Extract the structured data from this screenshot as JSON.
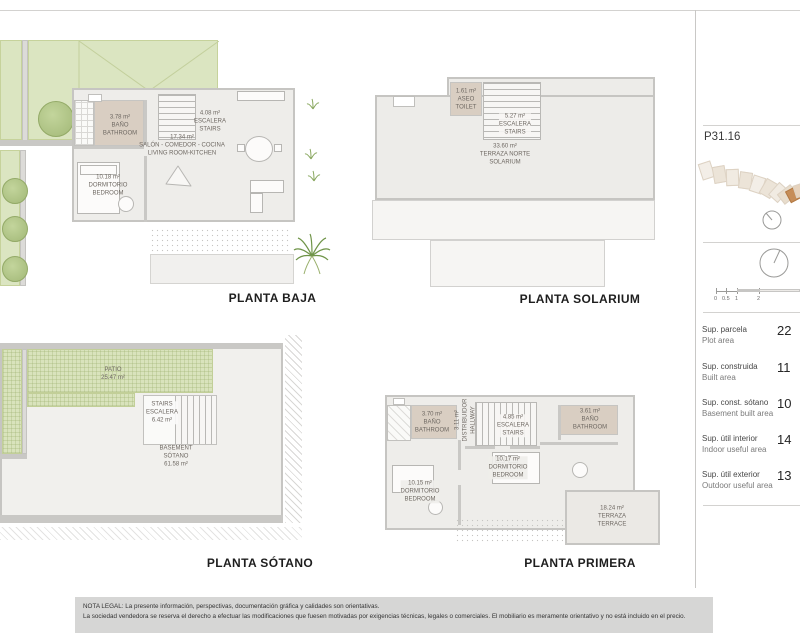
{
  "sheet": {
    "plot_id": "P31.16",
    "legal": {
      "line1": "NOTA LEGAL: La presente información, perspectivas, documentación gráfica y calidades son orientativas.",
      "line2": "La sociedad vendedora se reserva el derecho a efectuar las modificaciones que fuesen motivadas por exigencias técnicas, legales o comerciales. El mobiliario es meramente orientativo y no está incluido en el precio."
    }
  },
  "plans": {
    "baja": {
      "title": "PLANTA BAJA",
      "rooms": {
        "bano": {
          "area": "3.78 m²",
          "es": "BAÑO",
          "en": "BATHROOM"
        },
        "escalera": {
          "area": "4.08 m²",
          "es": "ESCALERA",
          "en": "STAIRS"
        },
        "salon": {
          "area": "17.34 m²",
          "es": "SALÓN - COMEDOR - COCINA",
          "en": "LIVING ROOM-KITCHEN"
        },
        "dormitorio": {
          "area": "10.18 m²",
          "es": "DORMITORIO",
          "en": "BEDROOM"
        }
      }
    },
    "solarium": {
      "title": "PLANTA SOLARIUM",
      "rooms": {
        "aseo": {
          "area": "1.61 m²",
          "es": "ASEO",
          "en": "TOILET"
        },
        "escalera": {
          "area": "5.27 m²",
          "es": "ESCALERA",
          "en": "STAIRS"
        },
        "terraza": {
          "area": "33.60 m²",
          "es": "TERRAZA NORTE",
          "en": "SOLARIUM"
        }
      }
    },
    "sotano": {
      "title": "PLANTA SÓTANO",
      "rooms": {
        "patio": {
          "es": "PATIO",
          "area": "25.47 m²"
        },
        "escalera": {
          "en": "STAIRS",
          "es": "ESCALERA",
          "area": "6.42 m²"
        },
        "sotano": {
          "en": "BASEMENT",
          "es": "SÓTANO",
          "area": "61.58 m²"
        }
      }
    },
    "primera": {
      "title": "PLANTA PRIMERA",
      "rooms": {
        "bano1": {
          "area": "3.70 m²",
          "es": "BAÑO",
          "en": "BATHROOM"
        },
        "distribuidor": {
          "area": "3.11 m²",
          "es": "DISTRIBUIDOR",
          "en": "HALLWAY"
        },
        "escalera": {
          "area": "4.85 m²",
          "es": "ESCALERA",
          "en": "STAIRS"
        },
        "bano2": {
          "area": "3.61 m²",
          "es": "BAÑO",
          "en": "BATHROOM"
        },
        "dormitorio1": {
          "area": "10.17 m²",
          "es": "DORMITORIO",
          "en": "BEDROOM"
        },
        "dormitorio2": {
          "area": "10.15 m²",
          "es": "DORMITORIO",
          "en": "BEDROOM"
        },
        "terraza": {
          "area": "18.24 m²",
          "es": "TERRAZA",
          "en": "TERRACE"
        }
      }
    }
  },
  "sidebar": {
    "plot_id": "P31.16",
    "scale_labels": [
      "0",
      "0.5",
      "1",
      "2"
    ],
    "areas": [
      {
        "es": "Sup. parcela",
        "en": "Plot area",
        "value": "22"
      },
      {
        "es": "Sup. construida",
        "en": "Built area",
        "value": "11"
      },
      {
        "es": "Sup. const. sótano",
        "en": "Basement built area",
        "value": "10"
      },
      {
        "es": "Sup. útil interior",
        "en": "Indoor useful area",
        "value": "14"
      },
      {
        "es": "Sup. útil exterior",
        "en": "Outdoor useful area",
        "value": "13"
      }
    ],
    "colors": {
      "plot_highlight": "#c68d58",
      "garden_green": "#dbe5c1",
      "bathroom_tan": "#d9cec2",
      "wall_gray": "#c9c8c5"
    }
  }
}
